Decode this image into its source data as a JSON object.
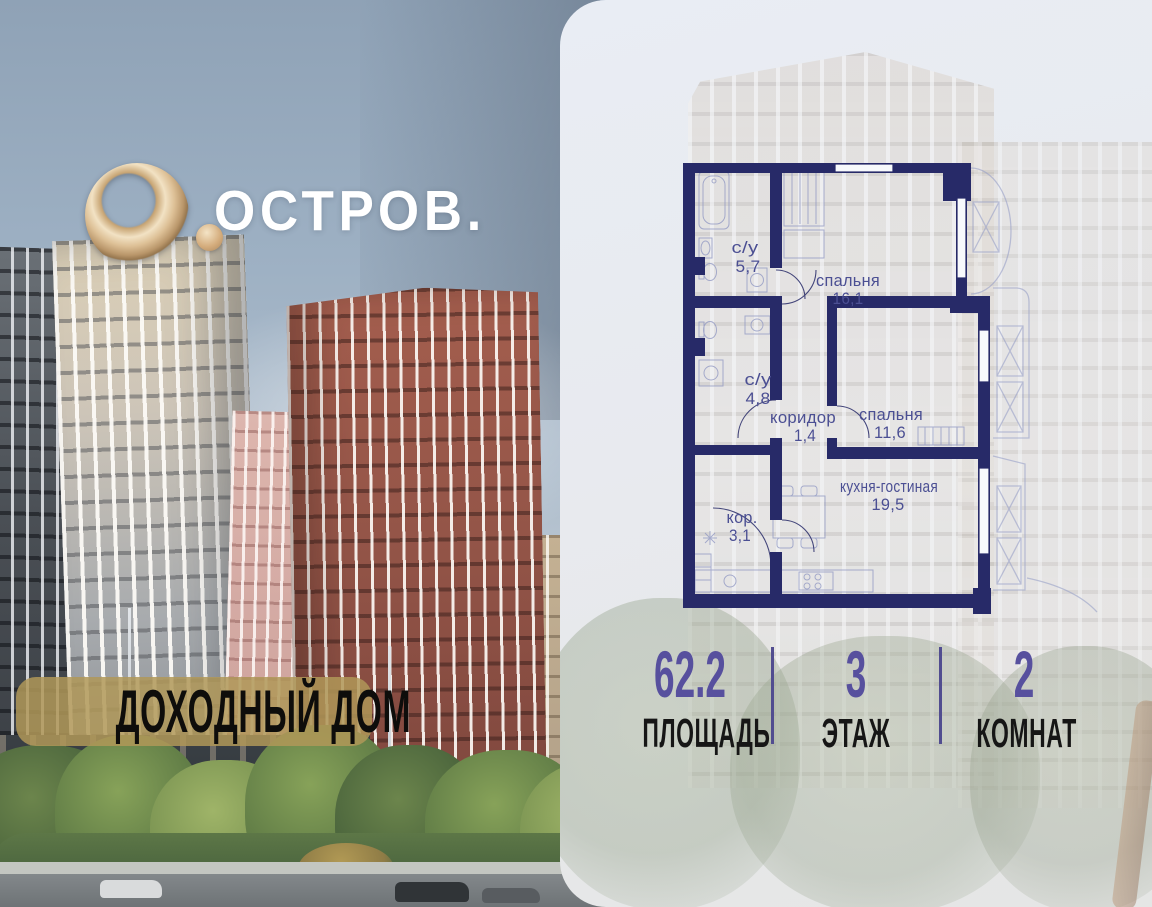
{
  "brand": {
    "name": "ОСТРОВ.",
    "logo_mark": "O.",
    "badge": "ДОХОДНЫЙ ДОМ"
  },
  "floor_plan": {
    "rooms": [
      {
        "name": "с/у",
        "area": "5,7"
      },
      {
        "name": "спальня",
        "area": "16,1"
      },
      {
        "name": "с/у",
        "area": "4,8"
      },
      {
        "name": "коридор",
        "area": "1,4"
      },
      {
        "name": "спальня",
        "area": "11,6"
      },
      {
        "name": "кухня-гостиная",
        "area": "19,5"
      },
      {
        "name": "кор.",
        "area": "3,1"
      }
    ]
  },
  "stats": [
    {
      "value": "62.2",
      "label": "ПЛОЩАДЬ"
    },
    {
      "value": "3",
      "label": "ЭТАЖ"
    },
    {
      "value": "2",
      "label": "КОМНАТ"
    }
  ],
  "colors": {
    "wall_navy": "#272a68",
    "room_label_blue": "#4b4f93",
    "stat_accent_purple": "#57509e",
    "badge_gold": "#b09858",
    "logo_gold": "#d9bc8e"
  }
}
